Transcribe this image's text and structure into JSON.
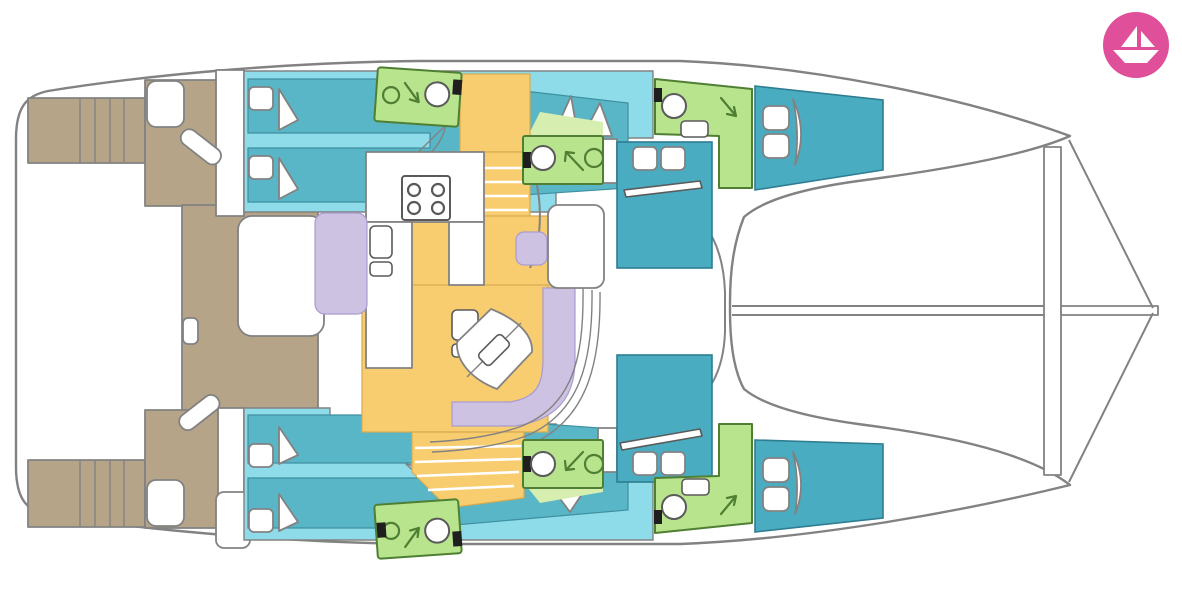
{
  "page": {
    "background": "#ffffff"
  },
  "figure": {
    "kind": "boat-floor-plan",
    "subject": "catamaran-interior-top-view"
  },
  "palette": {
    "page_bg": "#ffffff",
    "outline": "#828282",
    "deck_teak": "#b6a488",
    "cabin_light": "#8edbe9",
    "cabin_mid": "#58b6c6",
    "cabin_mid_stroke": "#3e8fa0",
    "cabin_deep": "#4aacc0",
    "cabin_deep_stroke": "#2e7d91",
    "bathroom": "#b9e48e",
    "bathroom_light": "#d6eeb0",
    "bathroom_stroke": "#4f7f33",
    "floor": "#f8cd70",
    "floor_stroke": "#d8a94e",
    "upholstery": "#cdc2e2",
    "upholstery_stroke": "#a99bd0",
    "fixture_stroke": "#5a5a5a",
    "door_marker": "#1f1f1f",
    "brand": "#df4f9a",
    "brand_glyph": "#ffffff"
  }
}
